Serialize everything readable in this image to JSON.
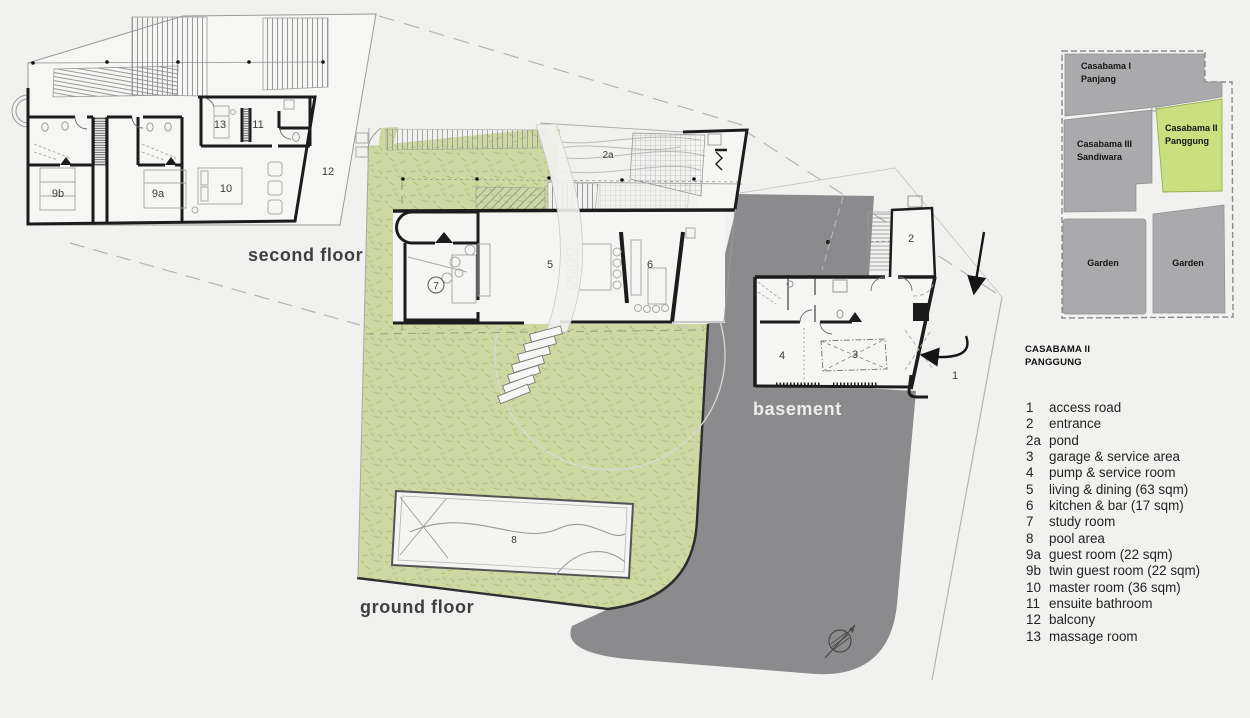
{
  "title": {
    "line1": "CASABAMA II",
    "line2": "PANGGUNG"
  },
  "plans": {
    "second_floor": {
      "label": "second floor",
      "room_labels": {
        "r9b": "9b",
        "r9a": "9a",
        "r10": "10",
        "r13": "13",
        "r11": "11",
        "r12": "12"
      }
    },
    "ground_floor": {
      "label": "ground floor",
      "room_labels": {
        "r7": "7",
        "r5": "5",
        "r6": "6",
        "r2a": "2a",
        "r8": "8"
      }
    },
    "basement": {
      "label": "basement",
      "room_labels": {
        "r4": "4",
        "r3": "3",
        "r2": "2",
        "r1": "1"
      }
    }
  },
  "site_plan": {
    "parcels": [
      {
        "id": "casabama-1",
        "name_line1": "Casabama I",
        "name_line2": "Panjang",
        "highlight": false
      },
      {
        "id": "casabama-3",
        "name_line1": "Casabama III",
        "name_line2": "Sandiwara",
        "highlight": false
      },
      {
        "id": "casabama-2",
        "name_line1": "Casabama II",
        "name_line2": "Panggung",
        "highlight": true
      },
      {
        "id": "garden-left",
        "name_line1": "Garden"
      },
      {
        "id": "garden-right",
        "name_line1": "Garden"
      }
    ]
  },
  "legend": {
    "items": [
      {
        "num": "1",
        "label": "access road"
      },
      {
        "num": "2",
        "label": "entrance"
      },
      {
        "num": "2a",
        "label": "pond"
      },
      {
        "num": "3",
        "label": "garage & service area"
      },
      {
        "num": "4",
        "label": "pump & service room"
      },
      {
        "num": "5",
        "label": "living & dining (63 sqm)"
      },
      {
        "num": "6",
        "label": "kitchen & bar (17 sqm)"
      },
      {
        "num": "7",
        "label": "study room"
      },
      {
        "num": "8",
        "label": "pool area"
      },
      {
        "num": "9a",
        "label": "guest room (22 sqm)"
      },
      {
        "num": "9b",
        "label": "twin guest room (22 sqm)"
      },
      {
        "num": "10",
        "label": "master room (36 sqm)"
      },
      {
        "num": "11",
        "label": "ensuite bathroom"
      },
      {
        "num": "12",
        "label": "balcony"
      },
      {
        "num": "13",
        "label": "massage room"
      }
    ]
  },
  "colors": {
    "background": "#f1f1ef",
    "garden_green": "#cdd8a2",
    "site_green": "#cbdf80",
    "driveway_gray": "#8b8b8d",
    "site_gray": "#aaaaac",
    "wall_black": "#1c1c1c"
  }
}
